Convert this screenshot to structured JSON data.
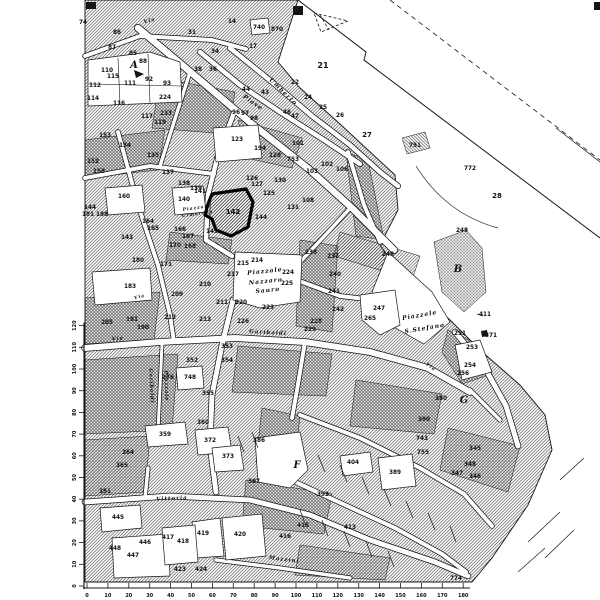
{
  "meta": {
    "description": "Scanned black-and-white cadastral town map with highlighted parcel 142",
    "background": "#ffffff",
    "ink": "#151515"
  },
  "map": {
    "city_region": {
      "pts": "85,0 298,0 278,62 300,88 340,124 368,150 395,175 398,210 380,245 405,280 450,320 480,350 520,385 545,415 552,450 528,505 492,558 472,582 85,582",
      "p": "h1"
    },
    "patches": [
      {
        "pts": "160,78 235,92 228,134 152,128",
        "p": "h2"
      },
      {
        "pts": "85,140 165,130 158,170 85,178",
        "p": "h2"
      },
      {
        "pts": "238,120 302,138 292,168 246,158",
        "p": "cross"
      },
      {
        "pts": "170,232 232,240 228,264 166,260",
        "p": "h2"
      },
      {
        "pts": "85,298 160,292 154,340 85,344",
        "p": "h2"
      },
      {
        "pts": "238,346 332,354 326,396 232,392",
        "p": "h2"
      },
      {
        "pts": "300,240 338,246 332,332 296,326",
        "p": "h2"
      },
      {
        "pts": "356,380 442,394 434,434 350,426",
        "p": "h2"
      },
      {
        "pts": "246,480 332,494 324,534 242,526",
        "p": "h2"
      },
      {
        "pts": "85,360 178,354 172,430 85,434",
        "p": "h2"
      },
      {
        "pts": "346,152 368,160 384,240 356,236",
        "p": "h2"
      },
      {
        "pts": "448,428 520,446 508,492 440,470",
        "p": "cross"
      },
      {
        "pts": "85,440 150,436 145,492 85,496",
        "p": "cross"
      },
      {
        "pts": "262,408 300,416 294,470 256,462",
        "p": "h2"
      },
      {
        "pts": "300,545 390,558 385,580 295,575",
        "p": "cross"
      },
      {
        "pts": "340,232 420,256 412,280 334,256",
        "p": "h1"
      },
      {
        "pts": "448,330 478,344 492,374 462,384 442,352",
        "p": "h2"
      },
      {
        "pts": "402,138 425,132 430,148 407,154",
        "p": "h2"
      },
      {
        "pts": "434,242 466,230 482,248 486,292 464,312 442,292",
        "p": "cross"
      }
    ],
    "streets": [
      {
        "d": "M85,56 L140,36 L212,40 L246,49",
        "w": 4
      },
      {
        "d": "M230,48 L272,82 L312,116 L350,145 L380,172 L398,186",
        "w": 4.5
      },
      {
        "d": "M200,52 L240,85 L280,112 L324,140 L360,164",
        "w": 4.5
      },
      {
        "d": "M138,28 L200,80 L252,124 L310,170 L352,208 L394,250",
        "w": 6.5
      },
      {
        "d": "M235,110 L218,155 L208,195 L206,240 L232,256",
        "w": 4.5
      },
      {
        "d": "M190,72 L174,122 L160,166",
        "w": 3.5
      },
      {
        "d": "M85,178 L150,166 L214,174",
        "w": 4
      },
      {
        "d": "M118,132 L138,205 L158,265 L170,315 L174,342",
        "w": 4
      },
      {
        "d": "M85,348 L160,342 L235,338 L305,342 L370,352 L428,368 L470,392",
        "w": 6
      },
      {
        "d": "M233,300 L222,345 L212,395 L210,445 L216,492",
        "w": 5
      },
      {
        "d": "M162,344 L158,432",
        "w": 3
      },
      {
        "d": "M85,502 L170,496 L250,500 L310,515 L370,540 L435,562 L468,576",
        "w": 5
      },
      {
        "d": "M455,332 L485,368 L506,406 L518,446",
        "w": 5
      },
      {
        "d": "M300,415 L360,438 L420,468 L464,494 L492,526",
        "w": 4
      },
      {
        "d": "M265,468 L330,498 L395,528 L442,554 L466,572",
        "w": 4
      },
      {
        "d": "M302,282 L340,296 L374,300",
        "w": 4
      },
      {
        "d": "M302,260 L330,230 L352,206",
        "w": 3.5
      },
      {
        "d": "M348,152 L364,205 L380,242",
        "w": 4
      },
      {
        "d": "M305,342 L297,390 L292,418",
        "w": 4
      },
      {
        "d": "M148,468 L145,498",
        "w": 3.5
      },
      {
        "d": "M470,390 L500,420",
        "w": 3.5
      },
      {
        "d": "M216,560 L280,568 L350,578",
        "w": 3.5
      }
    ],
    "white_shapes": [
      "88,60 150,52 180,62 182,102 88,106",
      "213,128 258,125 262,158 216,162",
      "235,252 302,255 300,302 260,308 233,300",
      "388,252 432,292 450,322 424,344 392,326 372,292",
      "172,188 203,186 206,212 175,215",
      "105,188 142,185 145,212 108,215",
      "92,272 150,268 152,300 95,305",
      "176,368 202,366 204,388 178,390",
      "255,438 300,432 308,470 290,488 258,482",
      "222,518 262,514 266,556 226,560",
      "112,538 168,534 170,576 114,578",
      "192,522 220,518 224,556 196,558",
      "145,426 185,422 188,444 148,447",
      "195,430 228,427 232,452 198,455",
      "212,448 240,445 244,470 215,472",
      "378,458 412,454 416,486 382,490",
      "360,295 395,290 400,325 380,335 362,320",
      "455,345 480,340 492,372 462,380",
      "100,508 140,505 142,528 102,532",
      "162,528 195,525 198,562 165,565",
      "250,20 268,18 270,33 252,35",
      "340,456 370,452 373,472 343,476"
    ],
    "lines": [
      {
        "d": "M298,0 L366,52 L364,60 L600,238",
        "w": 1
      },
      {
        "d": "M390,0 L600,160",
        "w": 0.8,
        "dash": "5,4"
      },
      {
        "d": "M556,128 L600,162",
        "w": 0.7
      },
      {
        "d": "M416,166 Q446,214 498,228",
        "w": 0.7
      },
      {
        "d": "M118,58 L120,104",
        "w": 0.6
      },
      {
        "d": "M148,54 L150,103",
        "w": 0.6
      },
      {
        "d": "M89,84 L181,86",
        "w": 0.6
      },
      {
        "d": "M528,542 L560,512",
        "w": 0.7
      },
      {
        "d": "M545,558 L574,530",
        "w": 0.7
      },
      {
        "d": "M518,572 L545,548",
        "w": 0.7
      },
      {
        "d": "M560,480 L584,458",
        "w": 0.7
      },
      {
        "d": "M477,314 L483,316",
        "w": 0.7
      },
      {
        "d": "M314,13 L348,21 L321,32 Z",
        "w": 0.8,
        "dash": "3,2"
      },
      {
        "d": "M320,15 L329,30",
        "w": 0.7,
        "dash": "3,2"
      }
    ],
    "ticks": [
      [
        318,
        455,
        325,
        472
      ],
      [
        340,
        465,
        347,
        482
      ],
      [
        362,
        477,
        369,
        494
      ],
      [
        384,
        489,
        391,
        506
      ],
      [
        406,
        501,
        413,
        518
      ],
      [
        428,
        513,
        435,
        530
      ],
      [
        450,
        526,
        456,
        542
      ],
      [
        300,
        510,
        306,
        526
      ],
      [
        322,
        520,
        328,
        536
      ],
      [
        344,
        531,
        350,
        547
      ],
      [
        366,
        541,
        372,
        557
      ],
      [
        388,
        551,
        394,
        567
      ],
      [
        252,
        432,
        258,
        448
      ],
      [
        238,
        436,
        244,
        452
      ]
    ],
    "marks": [
      "293,6 303,6 303,15 293,15",
      "86,2 96,2 96,9 86,9",
      "594,2 600,2 600,10 594,10",
      "134,70 144,74 136,78",
      "481,331 487,330 488,336 482,337"
    ],
    "highlight": {
      "label": "142",
      "pts": "212,194 246,189 253,202 248,227 231,236 216,230 212,219 205,215 208,204",
      "sw": 3.2
    },
    "parcel_labels": [
      [
        "74",
        83,
        24
      ],
      [
        "86",
        117,
        34
      ],
      [
        "87",
        112,
        49
      ],
      [
        "85",
        133,
        55
      ],
      [
        "88",
        143,
        63
      ],
      [
        "110",
        107,
        72
      ],
      [
        "115",
        113,
        78
      ],
      [
        "112",
        95,
        87
      ],
      [
        "111",
        130,
        85
      ],
      [
        "92",
        149,
        81
      ],
      [
        "93",
        167,
        85
      ],
      [
        "114",
        93,
        100
      ],
      [
        "116",
        119,
        105
      ],
      [
        "117",
        147,
        118
      ],
      [
        "224",
        165,
        99
      ],
      [
        "233",
        166,
        115
      ],
      [
        "119",
        160,
        124
      ],
      [
        "153",
        105,
        137
      ],
      [
        "134",
        125,
        147
      ],
      [
        "14",
        232,
        23
      ],
      [
        "17",
        253,
        48
      ],
      [
        "740",
        259,
        29
      ],
      [
        "870",
        277,
        31
      ],
      [
        "31",
        192,
        34
      ],
      [
        "34",
        215,
        53
      ],
      [
        "36",
        213,
        71
      ],
      [
        "38",
        198,
        71
      ],
      [
        "44",
        246,
        91
      ],
      [
        "43",
        265,
        94
      ],
      [
        "46",
        287,
        114
      ],
      [
        "47",
        295,
        118
      ],
      [
        "22",
        295,
        84
      ],
      [
        "24",
        308,
        99
      ],
      [
        "25",
        323,
        109
      ],
      [
        "26",
        340,
        117
      ],
      [
        "27",
        367,
        137,
        7
      ],
      [
        "21",
        323,
        68,
        8
      ],
      [
        "194",
        260,
        150
      ],
      [
        "128",
        275,
        157
      ],
      [
        "101",
        298,
        145
      ],
      [
        "753",
        293,
        161
      ],
      [
        "103",
        312,
        173
      ],
      [
        "102",
        327,
        166
      ],
      [
        "106",
        342,
        171
      ],
      [
        "123",
        237,
        141
      ],
      [
        "96",
        236,
        114
      ],
      [
        "97",
        245,
        115
      ],
      [
        "98",
        254,
        120
      ],
      [
        "135",
        153,
        157
      ],
      [
        "137",
        168,
        174
      ],
      [
        "138",
        184,
        185
      ],
      [
        "139",
        196,
        190
      ],
      [
        "152",
        93,
        163
      ],
      [
        "158",
        99,
        173
      ],
      [
        "160",
        124,
        198
      ],
      [
        "144",
        90,
        209
      ],
      [
        "188",
        102,
        216
      ],
      [
        "181",
        88,
        216
      ],
      [
        "143",
        127,
        239
      ],
      [
        "180",
        138,
        262
      ],
      [
        "171",
        166,
        266
      ],
      [
        "140",
        184,
        201
      ],
      [
        "141",
        200,
        193
      ],
      [
        "143",
        212,
        233
      ],
      [
        "144",
        261,
        219
      ],
      [
        "126",
        252,
        180
      ],
      [
        "127",
        257,
        186
      ],
      [
        "125",
        269,
        195
      ],
      [
        "130",
        280,
        182
      ],
      [
        "131",
        293,
        209
      ],
      [
        "108",
        308,
        202
      ],
      [
        "164",
        148,
        223
      ],
      [
        "165",
        153,
        230
      ],
      [
        "166",
        180,
        231
      ],
      [
        "167",
        188,
        238
      ],
      [
        "170",
        175,
        247
      ],
      [
        "168",
        190,
        248
      ],
      [
        "751",
        415,
        147
      ],
      [
        "772",
        470,
        170
      ],
      [
        "28",
        497,
        198,
        7
      ],
      [
        "248",
        462,
        232
      ],
      [
        "248",
        388,
        256
      ],
      [
        "217",
        233,
        276
      ],
      [
        "214",
        257,
        262
      ],
      [
        "215",
        243,
        265
      ],
      [
        "224",
        288,
        274
      ],
      [
        "225",
        287,
        285
      ],
      [
        "220",
        241,
        304
      ],
      [
        "223",
        268,
        309
      ],
      [
        "226",
        243,
        323
      ],
      [
        "228",
        316,
        323
      ],
      [
        "229",
        310,
        331
      ],
      [
        "238",
        311,
        254
      ],
      [
        "237",
        333,
        258
      ],
      [
        "240",
        335,
        276
      ],
      [
        "241",
        334,
        293
      ],
      [
        "242",
        338,
        311
      ],
      [
        "210",
        205,
        286
      ],
      [
        "211",
        222,
        304
      ],
      [
        "213",
        205,
        321
      ],
      [
        "209",
        177,
        296
      ],
      [
        "212",
        170,
        319
      ],
      [
        "191",
        132,
        321
      ],
      [
        "190",
        143,
        329
      ],
      [
        "205",
        107,
        324
      ],
      [
        "183",
        130,
        288
      ],
      [
        "352",
        192,
        362
      ],
      [
        "353",
        227,
        348
      ],
      [
        "354",
        227,
        362
      ],
      [
        "355",
        208,
        395
      ],
      [
        "748",
        190,
        379
      ],
      [
        "176",
        168,
        379
      ],
      [
        "360",
        203,
        424
      ],
      [
        "247",
        379,
        310
      ],
      [
        "265",
        370,
        320
      ],
      [
        "411",
        485,
        316
      ],
      [
        "371",
        491,
        337
      ],
      [
        "251",
        460,
        335
      ],
      [
        "253",
        472,
        349
      ],
      [
        "254",
        470,
        367
      ],
      [
        "256",
        463,
        375
      ],
      [
        "380",
        441,
        400
      ],
      [
        "390",
        424,
        421
      ],
      [
        "743",
        422,
        440
      ],
      [
        "755",
        423,
        454
      ],
      [
        "345",
        475,
        450
      ],
      [
        "348",
        470,
        466
      ],
      [
        "347",
        457,
        475
      ],
      [
        "346",
        475,
        478
      ],
      [
        "774",
        456,
        580
      ],
      [
        "386",
        259,
        442
      ],
      [
        "387",
        254,
        483
      ],
      [
        "404",
        353,
        464
      ],
      [
        "389",
        395,
        474
      ],
      [
        "392",
        323,
        496
      ],
      [
        "415",
        303,
        527
      ],
      [
        "416",
        285,
        538
      ],
      [
        "413",
        350,
        529
      ],
      [
        "359",
        165,
        436
      ],
      [
        "372",
        210,
        442
      ],
      [
        "373",
        228,
        458
      ],
      [
        "351",
        105,
        493
      ],
      [
        "364",
        128,
        454
      ],
      [
        "365",
        122,
        467
      ],
      [
        "445",
        118,
        519
      ],
      [
        "448",
        115,
        550
      ],
      [
        "447",
        133,
        557
      ],
      [
        "446",
        145,
        544
      ],
      [
        "417",
        168,
        539
      ],
      [
        "418",
        183,
        543
      ],
      [
        "419",
        203,
        535
      ],
      [
        "420",
        240,
        536
      ],
      [
        "423",
        180,
        571
      ],
      [
        "424",
        201,
        571
      ]
    ],
    "street_labels": [
      [
        "Via",
        150,
        22,
        -15,
        5
      ],
      [
        "Via",
        118,
        340,
        -5,
        5
      ],
      [
        "Via",
        140,
        298,
        -15,
        4.5
      ],
      [
        "Via",
        430,
        368,
        38,
        4.5
      ],
      [
        "Umberto",
        282,
        93,
        44,
        6
      ],
      [
        "Piave",
        252,
        104,
        35,
        6
      ],
      [
        "Garibaldi",
        268,
        334,
        3,
        5.5
      ],
      [
        "Piazzale",
        165,
        386,
        88,
        5
      ],
      [
        "Garibaldi",
        150,
        386,
        88,
        5
      ],
      [
        "Vittoria",
        172,
        500,
        -3,
        5.5
      ],
      [
        "Mazzini",
        284,
        561,
        7,
        5.5
      ],
      [
        "Piazzale",
        265,
        273,
        -6,
        6
      ],
      [
        "Nazzaro",
        266,
        283,
        -6,
        6
      ],
      [
        "Sauro",
        268,
        292,
        -6,
        6
      ],
      [
        "Piazzale",
        420,
        317,
        -10,
        6
      ],
      [
        "S.Stefano",
        425,
        330,
        -10,
        6
      ],
      [
        "Piazzale",
        197,
        209,
        -8,
        4.5
      ],
      [
        "Cimarosa",
        198,
        215,
        -8,
        4.5
      ]
    ],
    "building_letters": [
      [
        "A",
        134,
        68
      ],
      [
        "B",
        458,
        272
      ],
      [
        "F",
        297,
        468
      ],
      [
        "G",
        464,
        403
      ]
    ],
    "scale_bottom": {
      "y": 588,
      "x0": 87,
      "step": 20.9,
      "bar_end": 470,
      "labels": [
        "0",
        "10",
        "20",
        "30",
        "40",
        "50",
        "60",
        "70",
        "80",
        "90",
        "100",
        "110",
        "120",
        "130",
        "140",
        "150",
        "160",
        "170",
        "180"
      ]
    },
    "scale_left": {
      "x": 84,
      "y0": 586,
      "step": 21.7,
      "labels": [
        "0",
        "10",
        "20",
        "30",
        "40",
        "50",
        "60",
        "70",
        "80",
        "90",
        "100",
        "110",
        "120"
      ]
    }
  }
}
